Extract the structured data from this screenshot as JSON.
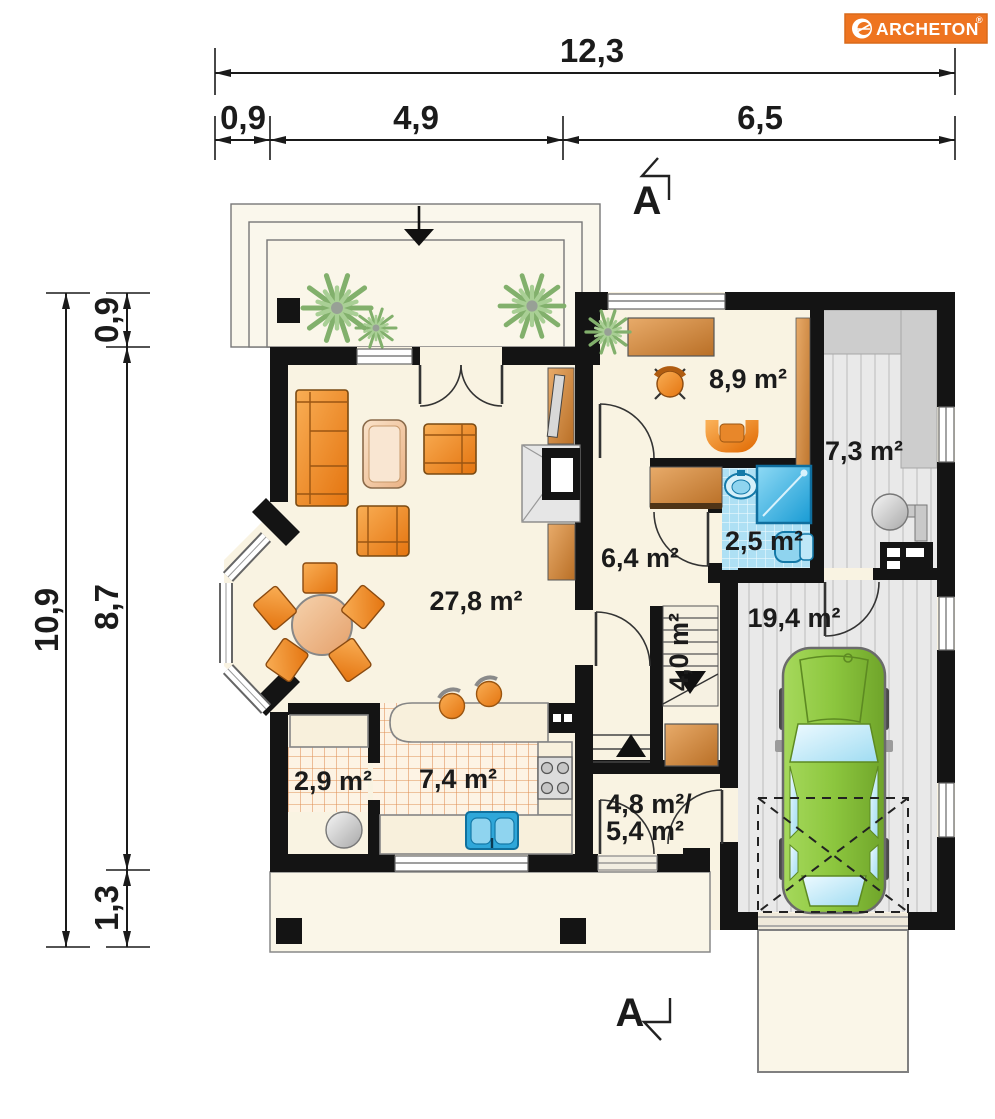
{
  "brand": {
    "name": "ARCHETON",
    "registered": "®"
  },
  "dims": {
    "top_total": "12,3",
    "top_segs": [
      "0,9",
      "4,9",
      "6,5"
    ],
    "left_total": "10,9",
    "left_segs": [
      "0,9",
      "8,7",
      "1,3"
    ]
  },
  "section": {
    "top": "A",
    "bottom": "A"
  },
  "rooms": {
    "living": "27,8 m²",
    "office": "8,9 m²",
    "boiler": "7,3 m²",
    "bath": "2,5 m²",
    "hall": "6,4 m²",
    "stairs": "4,0 m²",
    "garage": "19,4 m²",
    "pantry": "2,9 m²",
    "kitchen": "7,4 m²",
    "utility1": "4,8 m²/",
    "utility2": "5,4 m²"
  },
  "colors": {
    "wall": "#141414",
    "floor_cream": "#f9f3e2",
    "furniture_orange": "#ec7d1c",
    "wood": "#c8762e",
    "tile_blue": "#aee0f4",
    "fixture_blue": "#2fa7d9",
    "car_green": "#8cc63e",
    "garage_gray": "#e7e7e7",
    "logo_orange": "#ee7420",
    "dimension_black": "#1a1a1a"
  }
}
